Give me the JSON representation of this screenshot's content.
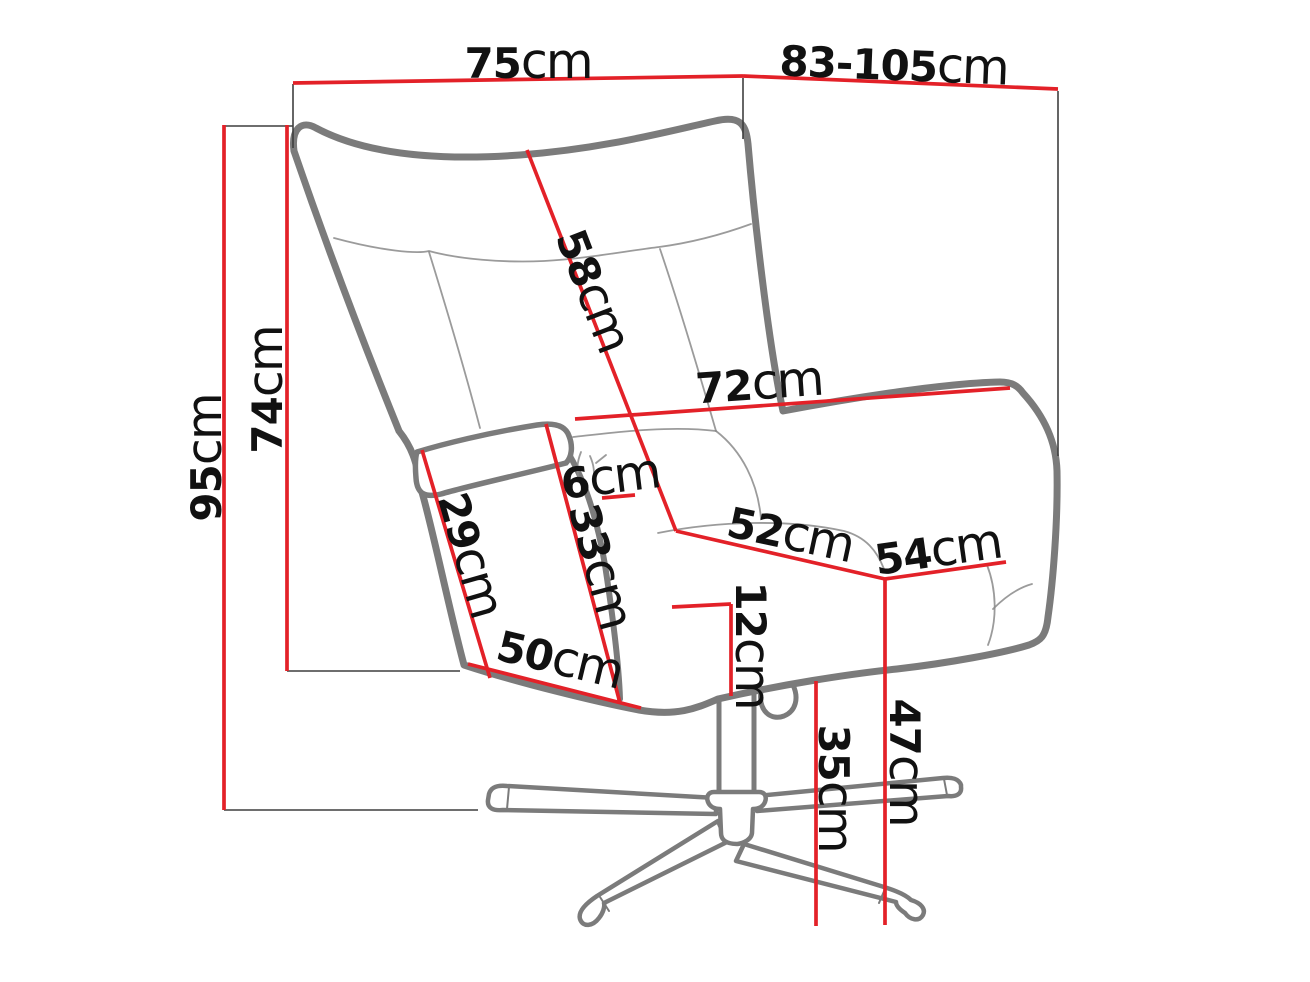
{
  "figure": {
    "kind": "furniture-dimension-diagram",
    "unit": "cm",
    "colors": {
      "background": "#ffffff",
      "dimension_line": "#e32128",
      "chair_outline": "#7b7b7b",
      "seam_line": "#8a8a8a",
      "extension_line": "#3f3f3f",
      "label_text": "#111111"
    },
    "dimensions": {
      "overall_width": {
        "value": "75",
        "unit": "cm"
      },
      "depth_range": {
        "value": "83-105",
        "unit": "cm"
      },
      "overall_height": {
        "value": "95",
        "unit": "cm"
      },
      "back_height": {
        "value": "74",
        "unit": "cm"
      },
      "backrest_length": {
        "value": "58",
        "unit": "cm"
      },
      "inner_width": {
        "value": "72",
        "unit": "cm"
      },
      "armrest_top_width": {
        "value": "6",
        "unit": "cm"
      },
      "armrest_front_edge": {
        "value": "29",
        "unit": "cm"
      },
      "armrest_inner_height": {
        "value": "33",
        "unit": "cm"
      },
      "base_edge": {
        "value": "50",
        "unit": "cm"
      },
      "seat_width": {
        "value": "52",
        "unit": "cm"
      },
      "seat_depth": {
        "value": "54",
        "unit": "cm"
      },
      "seat_thickness": {
        "value": "12",
        "unit": "cm"
      },
      "underseat_height": {
        "value": "35",
        "unit": "cm"
      },
      "seat_height": {
        "value": "47",
        "unit": "cm"
      }
    }
  }
}
